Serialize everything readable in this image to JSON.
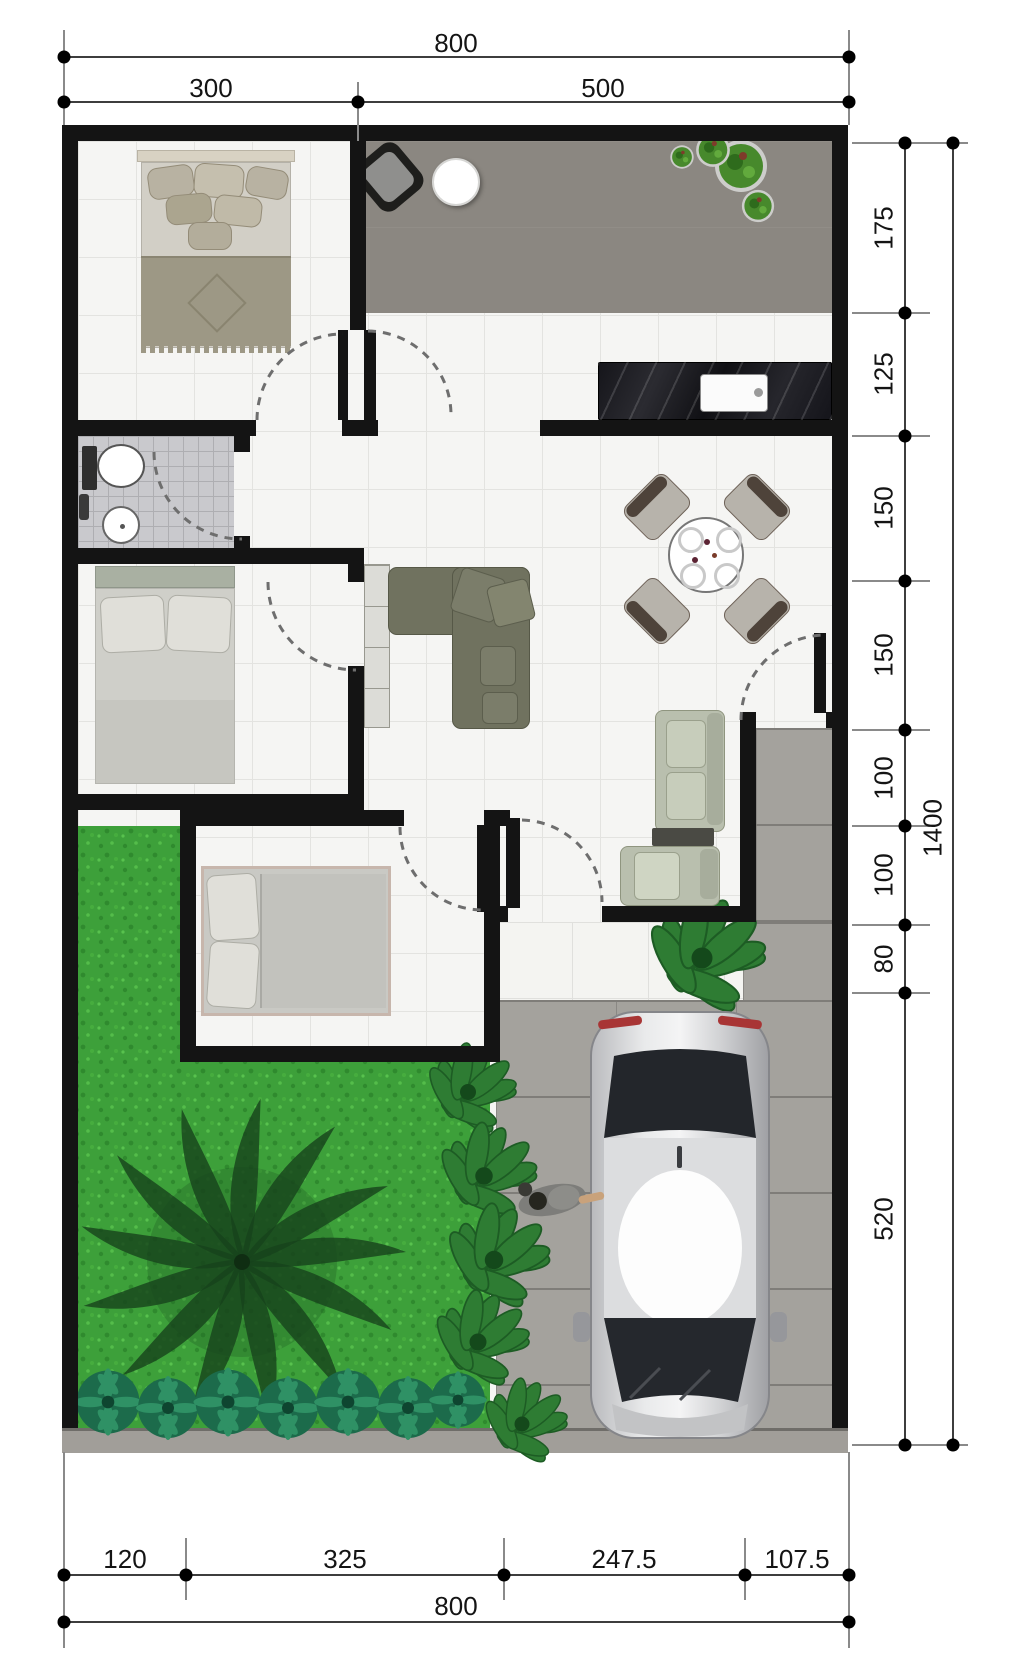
{
  "drawing": "house-floor-plan-top-view",
  "dims": {
    "top_total": "800",
    "top_segments": [
      "300",
      "500"
    ],
    "right_segments": [
      "175",
      "125",
      "150",
      "150",
      "100",
      "100",
      "80",
      "520"
    ],
    "right_total": "1400",
    "bottom_segments": [
      "120",
      "325",
      "247.5",
      "107.5"
    ],
    "bottom_total": "800"
  },
  "colors": {
    "wall": "#141414",
    "interior_tile": "#f5f5f3",
    "terrace_paving": "#8b8781",
    "driveway_paving": "#a4a29d",
    "bathroom_tile": "#c9c9cd",
    "grass": "#3da03a",
    "palm_foliage": "#16421c",
    "shrub": "#1c6b4b",
    "counter_marble": "#1a1a20",
    "sofa_olive": "#70725f",
    "sofa_sage": "#b9bfae",
    "car_body": "#d4d5d7",
    "dimension_text": "#141414"
  },
  "elements": [
    "bedroom-1-bed",
    "bedroom-2-bed",
    "bedroom-3-bed",
    "bathroom-toilet",
    "bathroom-sink",
    "kitchen-counter-sink",
    "dining-table-4-chairs",
    "l-shaped-sofa",
    "sofa-set-coffee-table",
    "terrace-chair-table",
    "terrace-potted-plants",
    "porch-plant",
    "garden-palm-tree",
    "garden-shrubs",
    "car-top-view",
    "person-figure",
    "door-swing-arcs"
  ]
}
